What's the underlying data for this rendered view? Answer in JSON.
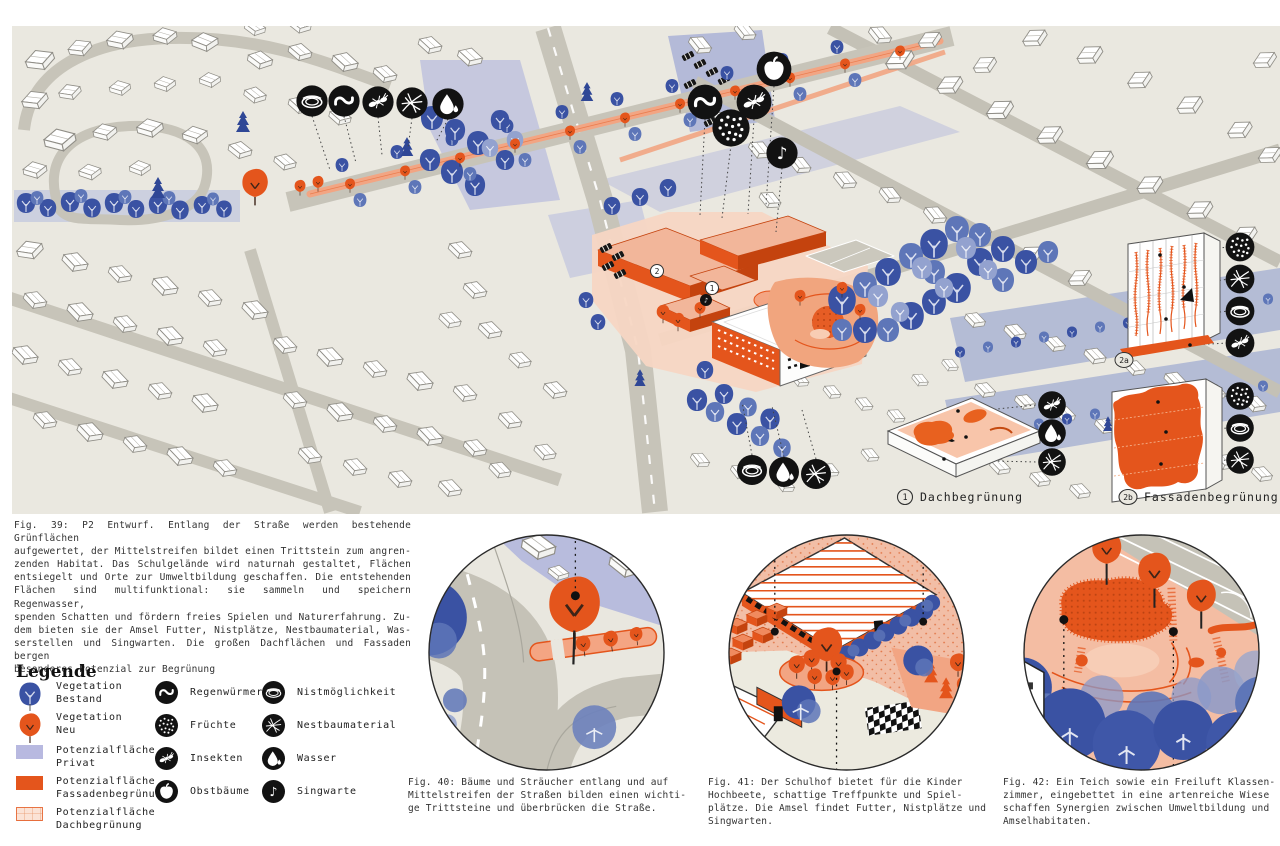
{
  "board": {
    "fig39": {
      "lines": [
        "Fig. 39: P2 Entwurf. Entlang der Straße werden bestehende Grünflächen",
        "aufgewertet, der Mittelstreifen bildet einen Trittstein zum angren-",
        "zenden Habitat. Das Schulgelände wird naturnah gestaltet, Flächen",
        "entsiegelt und Orte zur Umweltbildung geschaffen. Die entstehenden",
        "Flächen sind multifunktional: sie sammeln und speichern Regenwasser,",
        "spenden Schatten und fördern freies Spielen und Naturerfahrung. Zu-",
        "dem bieten sie der Amsel Futter, Nistplätze, Nestbaumaterial, Was-",
        "serstellen und Singwarten. Die großen Dachflächen und Fassaden bergen",
        "besonderes Potenzial zur Begrünung"
      ]
    },
    "legend": {
      "title": "Legende",
      "col1": [
        {
          "icon": "tree-bestand",
          "line1": "Vegetation",
          "line2": "Bestand"
        },
        {
          "icon": "tree-neu",
          "line1": "Vegetation",
          "line2": "Neu"
        },
        {
          "icon": "swatch-privat",
          "line1": "Potenzialfläche",
          "line2": "Privat"
        },
        {
          "icon": "swatch-fassade",
          "line1": "Potenzialfläche",
          "line2": "Fassadenbegrünung"
        },
        {
          "icon": "swatch-dach",
          "line1": "Potenzialfläche",
          "line2": "Dachbegrünung"
        }
      ],
      "col2": [
        {
          "icon": "worm-icon",
          "label": "Regenwürmer"
        },
        {
          "icon": "fruits-icon",
          "label": "Früchte"
        },
        {
          "icon": "insect-icon",
          "label": "Insekten"
        },
        {
          "icon": "apple-icon",
          "label": "Obstbäume"
        }
      ],
      "col3": [
        {
          "icon": "nest-icon",
          "label": "Nistmöglichkeit"
        },
        {
          "icon": "twigs-icon",
          "label": "Nestbaumaterial"
        },
        {
          "icon": "drop-icon",
          "label": "Wasser"
        },
        {
          "icon": "note-icon",
          "label": "Singwarte"
        }
      ]
    },
    "map": {
      "badge_1": "1",
      "badge_2": "2",
      "badge_2a": "2a",
      "badge_2b": "2b",
      "label_dach": "Dachbegrünung",
      "label_fassade": "Fassadenbegrünung",
      "icon_rows": {
        "street_row": [
          "nest-icon",
          "worm-icon",
          "insect-icon",
          "twigs-icon",
          "drop-icon"
        ],
        "school_cluster": [
          "apple-icon",
          "worm-icon",
          "insect-icon",
          "fruits-icon",
          "note-icon"
        ],
        "gym_row": [
          "nest-icon",
          "drop-icon",
          "twigs-icon"
        ],
        "roof_detail": [
          "insect-icon",
          "drop-icon",
          "twigs-icon"
        ],
        "facade_2a_detail": [
          "fruits-icon",
          "twigs-icon",
          "nest-icon",
          "insect-icon"
        ],
        "facade_2b_detail": [
          "fruits-icon",
          "nest-icon",
          "twigs-icon"
        ]
      }
    },
    "fig40": {
      "lines": [
        "Fig. 40: Bäume und Sträucher entlang und auf",
        "Mittelstreifen der Straßen bilden einen wichti-",
        "ge Trittsteine und überbrücken die Straße."
      ]
    },
    "fig41": {
      "lines": [
        "Fig. 41: Der Schulhof bietet für die Kinder",
        "Hochbeete, schattige Treffpunkte und Spiel-",
        "plätze. Die Amsel findet Futter, Nistplätze und",
        "Singwarten."
      ]
    },
    "fig42": {
      "lines": [
        "Fig. 42: Ein Teich sowie ein Freiluft Klassen-",
        "zimmer, eingebettet in eine artenreiche Wiese",
        "schaffen Synergien zwischen Umweltbildung und",
        "Amselhabitaten."
      ]
    },
    "colors": {
      "background": "#eae8e0",
      "vegetation_bestand": "#3a52a3",
      "vegetation_neu": "#e4551c",
      "potenzial_privat": "#b8b9e0",
      "potenzial_fassade": "#e4551c",
      "potenzial_dach_bg": "#fbe3d6",
      "road": "#c7c4b9",
      "icon_black": "#121212"
    }
  }
}
